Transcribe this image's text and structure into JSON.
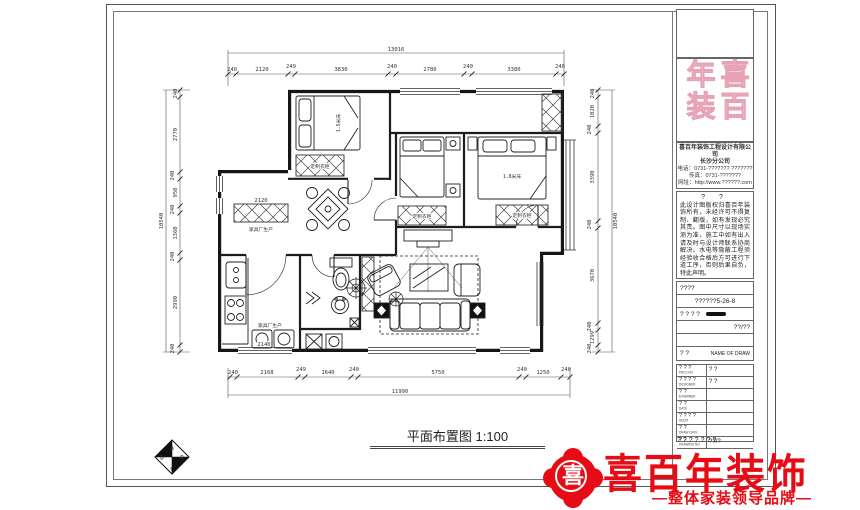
{
  "sheet": {
    "drawing_title": "平面布置图 1:100",
    "index_marker": {
      "top": "A",
      "right": "B",
      "bottom": "C",
      "left": "D"
    }
  },
  "plan": {
    "dims": {
      "top": {
        "overall": "13016",
        "segments": [
          "240",
          "2120",
          "249",
          "3830",
          "240",
          "2780",
          "240",
          "3380",
          "240"
        ]
      },
      "bottom": {
        "overall": "11990",
        "segments": [
          "240",
          "2168",
          "249",
          "1640",
          "240",
          "5750",
          "240",
          "1250",
          "240"
        ]
      },
      "left": {
        "overall": "10540",
        "segments": [
          "240",
          "2770",
          "240",
          "950",
          "240",
          "1360",
          "240",
          "2990",
          "240"
        ]
      },
      "right": {
        "overall": "10540",
        "segments": [
          "240",
          "1020",
          "240",
          "3390",
          "240",
          "3670",
          "240",
          "1299",
          "240"
        ]
      },
      "interior": [
        "2120",
        "2140"
      ]
    },
    "labels": {
      "cabinet_left": "家具厂生产",
      "kitchen_cabinet": "家具厂生产",
      "wardrobe_tl": "定制衣柜",
      "wardrobe_m": "定制衣柜",
      "wardrobe_r": "定制衣柜",
      "bed_tl": "1.5米床",
      "bed_r": "1.8米床"
    }
  },
  "titleblock": {
    "logo_text": "喜百年装",
    "company_name": "喜百年装饰工程设计有限公司",
    "company_sub": "长沙分公司",
    "contact_lines": [
      "电话：0731-??????? ???????",
      "传真：0731-???????",
      "网址：http://www.??????.com"
    ],
    "declaration_heading": "? ?",
    "declaration_text": "此设计图版权归喜百年装饰所有，未经许可不得复制、翻版，如有发现必究其责。图中尺寸以现场实测为准，施工中如有出入请及时与设计师联系协商解决。水电等隐蔽工程须经验收合格后方可进行下道工序，否则后果自负，特此声明。",
    "rows": {
      "row1": "????",
      "row2": "??????5-26-8",
      "row3_label": "? ? ? ?",
      "row4": "??/??",
      "name_label": "? ?",
      "name_of_draw": "NAME OF DRAW"
    },
    "table": [
      {
        "cn": "? ? ?",
        "en": "PROJ NO",
        "value": "? ?"
      },
      {
        "cn": "? ? ? ?",
        "en": "DESIGNER",
        "value": "? ?"
      },
      {
        "cn": "? ?",
        "en": "EXAMINER",
        "value": ""
      },
      {
        "cn": "? ?",
        "en": "DATE",
        "value": ""
      },
      {
        "cn": "? ? ? ?",
        "en": "AUDIT",
        "value": ""
      },
      {
        "cn": "? ?",
        "en": "DRAW DATE",
        "value": ""
      },
      {
        "cn": "? ?",
        "en": "DRAWING NO",
        "value": "??/?"
      }
    ],
    "footer": "???????"
  },
  "brand": {
    "emblem_char": "喜",
    "name": "喜百年装饰",
    "slogan": "—整体家装领导品牌—",
    "red": "#e60b15",
    "pink": "#f2c3d0"
  }
}
